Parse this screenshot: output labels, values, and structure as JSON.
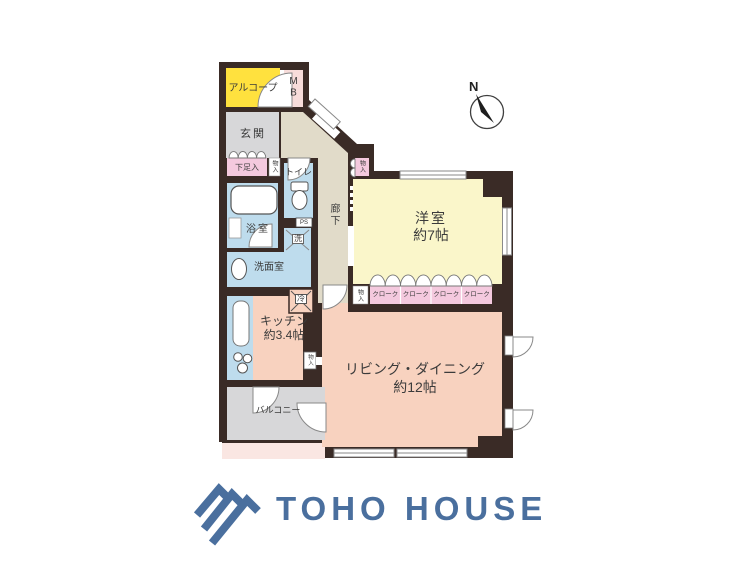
{
  "colors": {
    "wall": "#3a2b26",
    "alcove_yellow": "#ffe13e",
    "closet_pink": "#f4c9de",
    "meterbox_pink": "#f7dcda",
    "service_blue": "#bedced",
    "hallway_beige": "#e1dbc9",
    "bedroom_cream": "#faf6ca",
    "ldk_salmon": "#f8d2bf",
    "balcony_gray": "#d7d7d9",
    "outside_strip_pink": "#fae6e2",
    "logo_blue": "#4a6f9e"
  },
  "compass": {
    "north": "N"
  },
  "rooms": {
    "alcove": "アルコープ",
    "meter_box": "MB",
    "entrance": "玄関",
    "shoe_box": "下足入",
    "storage": "物入",
    "toilet": "トイレ",
    "bath": "浴室",
    "washer": "洗",
    "powder_room": "洗面室",
    "hallway": "廊下",
    "pipe_space": "PS",
    "bedroom": "洋室",
    "bedroom_size": "約7帖",
    "fridge": "冷",
    "kitchen": "キッチン",
    "kitchen_size": "約3.4帖",
    "living": "リビング・ダイニング",
    "living_size": "約12帖",
    "balcony": "バルコニー"
  },
  "cloaks": [
    "クローク",
    "クローク",
    "クローク",
    "クローク"
  ],
  "branding": {
    "name": "TOHO HOUSE"
  }
}
